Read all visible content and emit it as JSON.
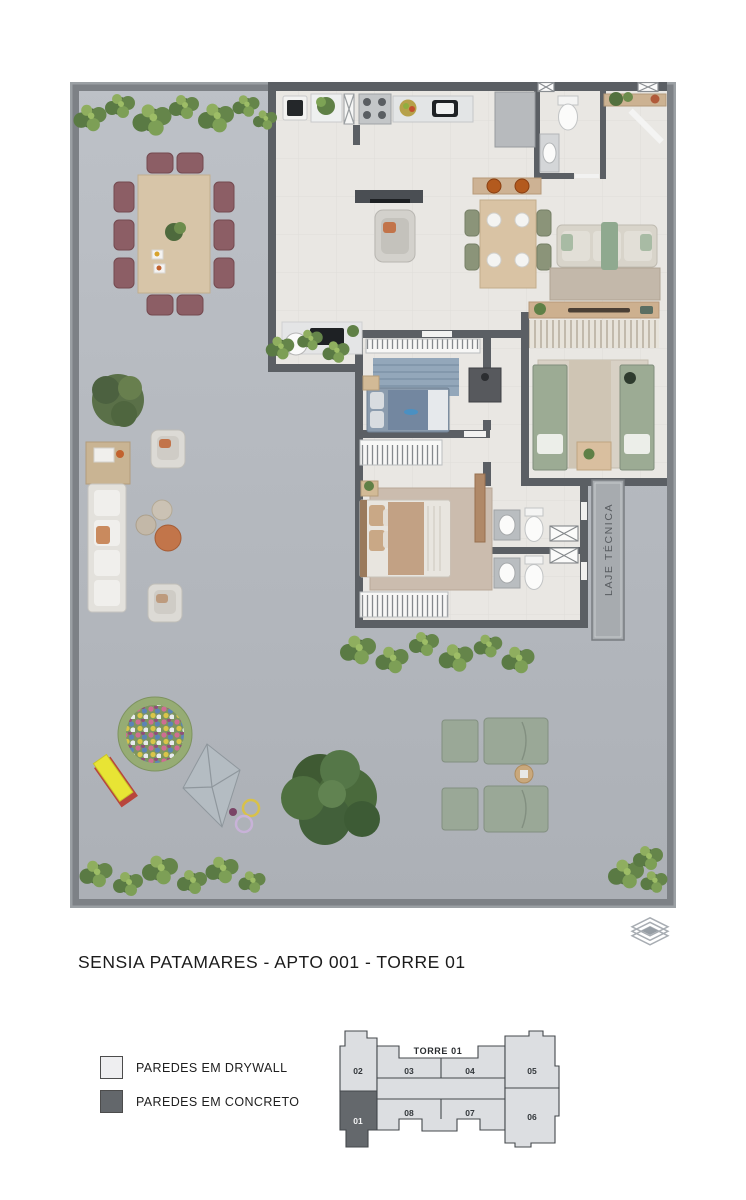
{
  "title": "SENSIA PATAMARES -  APTO 001 - TORRE 01",
  "floorplan": {
    "laje_tecnica_label": "LAJE TÉCNICA",
    "colors": {
      "terrace_floor": "#b4b8be",
      "interior_floor": "#e9e7e3",
      "concrete_wall": "#7d8186",
      "partition_wall": "#5b5f64"
    }
  },
  "legend": {
    "items": [
      {
        "label": "PAREDES EM DRYWALL",
        "swatch_color": "#eeeef0"
      },
      {
        "label": "PAREDES EM CONCRETO",
        "swatch_color": "#63676b"
      }
    ]
  },
  "keyplan": {
    "tower_label": "TORRE 01",
    "highlighted_unit": "01",
    "units": [
      {
        "number": "01",
        "highlighted": true
      },
      {
        "number": "02",
        "highlighted": false
      },
      {
        "number": "03",
        "highlighted": false
      },
      {
        "number": "04",
        "highlighted": false
      },
      {
        "number": "05",
        "highlighted": false
      },
      {
        "number": "06",
        "highlighted": false
      },
      {
        "number": "07",
        "highlighted": false
      },
      {
        "number": "08",
        "highlighted": false
      }
    ],
    "colors": {
      "unit_fill": "#dcdee1",
      "highlight_fill": "#64686c",
      "outline": "#44484c"
    }
  },
  "icons": {
    "corner_mark": "stacked-diamonds-icon"
  }
}
